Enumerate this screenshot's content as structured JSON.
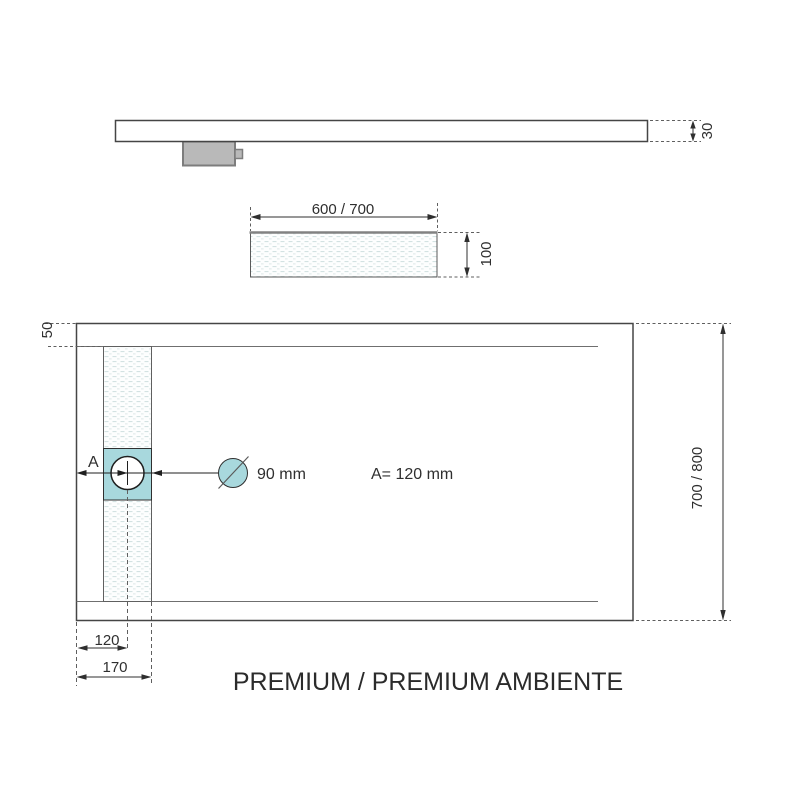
{
  "title": "PREMIUM / PREMIUM AMBIENTE",
  "side_view": {
    "thickness_label": "30"
  },
  "section_view": {
    "width_label": "600 / 700",
    "depth_label": "100"
  },
  "plan_view": {
    "rim_width_label": "50",
    "length_label": "700 / 800",
    "drain_offset_letter": "A",
    "drain_diameter_label": "90 mm",
    "drain_offset_value": "A= 120 mm",
    "drain_center_dim": "120",
    "channel_edge_dim": "170"
  },
  "colors": {
    "accent_teal": "#a8d8dd",
    "drain_trap_gray": "#b9b9b9",
    "line_dark": "#454545"
  }
}
